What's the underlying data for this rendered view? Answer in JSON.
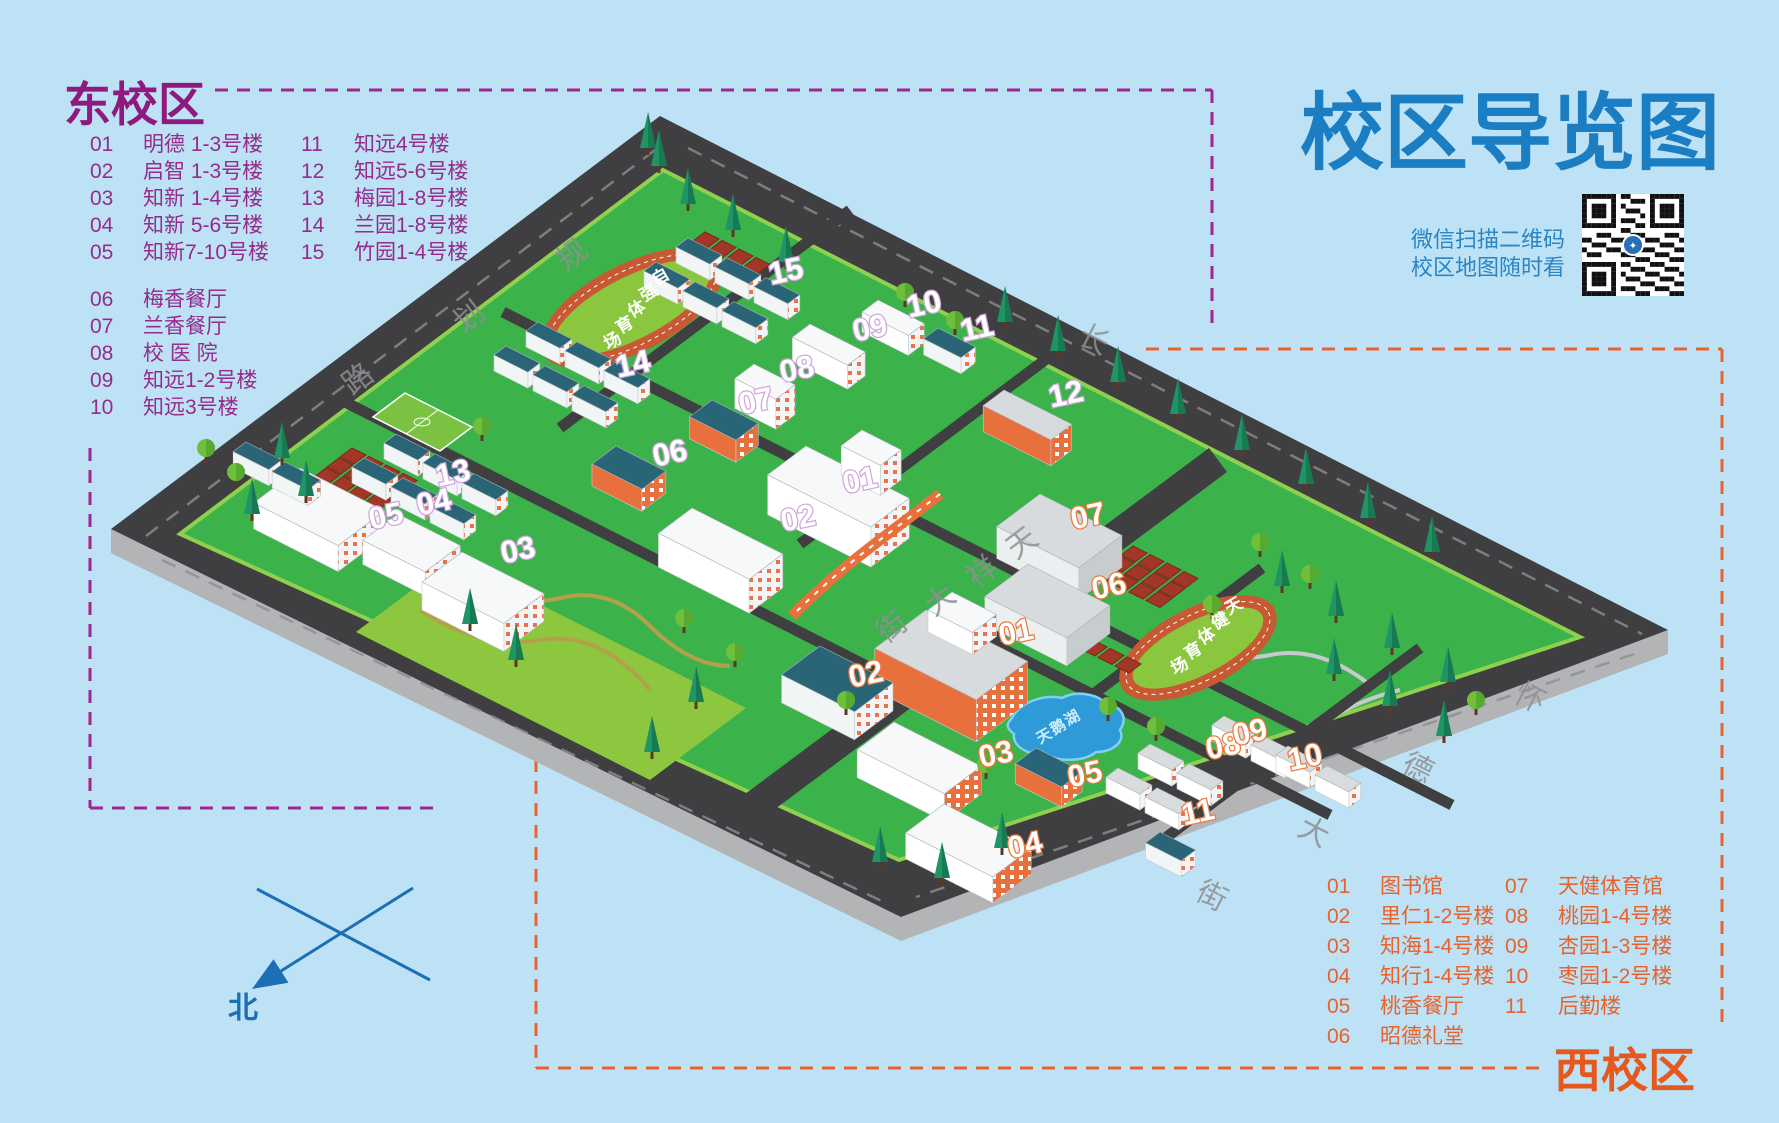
{
  "title": "校区导览图",
  "qr_note": {
    "line1": "微信扫描二维码",
    "line2": "校区地图随时看"
  },
  "compass": {
    "north": "北"
  },
  "legend_east": {
    "title": "东校区",
    "items_col1": [
      {
        "num": "01",
        "label": "明德 1-3号楼"
      },
      {
        "num": "02",
        "label": "启智 1-3号楼"
      },
      {
        "num": "03",
        "label": "知新 1-4号楼"
      },
      {
        "num": "04",
        "label": "知新 5-6号楼"
      },
      {
        "num": "05",
        "label": "知新7-10号楼"
      },
      {
        "num": "06",
        "label": "梅香餐厅"
      },
      {
        "num": "07",
        "label": "兰香餐厅"
      },
      {
        "num": "08",
        "label": "校 医 院"
      },
      {
        "num": "09",
        "label": "知远1-2号楼"
      },
      {
        "num": "10",
        "label": "知远3号楼"
      }
    ],
    "items_col2": [
      {
        "num": "11",
        "label": "知远4号楼"
      },
      {
        "num": "12",
        "label": "知远5-6号楼"
      },
      {
        "num": "13",
        "label": "梅园1-8号楼"
      },
      {
        "num": "14",
        "label": "兰园1-8号楼"
      },
      {
        "num": "15",
        "label": "竹园1-4号楼"
      }
    ]
  },
  "legend_west": {
    "title": "西校区",
    "items_col1": [
      {
        "num": "01",
        "label": "图书馆"
      },
      {
        "num": "02",
        "label": "里仁1-2号楼"
      },
      {
        "num": "03",
        "label": "知海1-4号楼"
      },
      {
        "num": "04",
        "label": "知行1-4号楼"
      },
      {
        "num": "05",
        "label": "桃香餐厅"
      },
      {
        "num": "06",
        "label": "昭德礼堂"
      }
    ],
    "items_col2": [
      {
        "num": "07",
        "label": "天健体育馆"
      },
      {
        "num": "08",
        "label": "桃园1-4号楼"
      },
      {
        "num": "09",
        "label": "杏园1-3号楼"
      },
      {
        "num": "10",
        "label": "枣园1-2号楼"
      },
      {
        "num": "11",
        "label": "后勤楼"
      }
    ]
  },
  "map": {
    "roads": [
      {
        "name": "规划路",
        "chars": [
          {
            "ch": "规",
            "x": 566,
            "y": 272,
            "r": -37
          },
          {
            "ch": "划",
            "x": 463,
            "y": 334,
            "r": -37
          },
          {
            "ch": "路",
            "x": 352,
            "y": 396,
            "r": -37
          }
        ]
      },
      {
        "name": "长",
        "chars": [
          {
            "ch": "长",
            "x": 1076,
            "y": 342,
            "r": 27
          }
        ]
      },
      {
        "name": "怀德大街",
        "chars": [
          {
            "ch": "怀",
            "x": 1512,
            "y": 700,
            "r": 27
          },
          {
            "ch": "德",
            "x": 1400,
            "y": 770,
            "r": 27
          },
          {
            "ch": "大",
            "x": 1296,
            "y": 834,
            "r": 27
          },
          {
            "ch": "街",
            "x": 1194,
            "y": 898,
            "r": 27
          }
        ]
      },
      {
        "name": "天祥大街",
        "chars": [
          {
            "ch": "天",
            "x": 1016,
            "y": 560,
            "r": -37
          },
          {
            "ch": "祥",
            "x": 976,
            "y": 589,
            "r": -37
          },
          {
            "ch": "大",
            "x": 934,
            "y": 617,
            "r": -37
          },
          {
            "ch": "街",
            "x": 886,
            "y": 644,
            "r": -37
          }
        ]
      }
    ],
    "stadiums": [
      {
        "name": "自强体育场",
        "x": 656,
        "y": 286,
        "dx": -12,
        "dy": 16,
        "r": -30
      },
      {
        "name": "天健体育场",
        "x": 1229,
        "y": 615,
        "dx": -13.5,
        "dy": 15,
        "r": -30
      }
    ],
    "lake": {
      "name": "天鹅湖",
      "x": 1040,
      "y": 744,
      "dx": 14,
      "dy": -9,
      "r": -30
    },
    "markers_east": [
      {
        "num": "01",
        "x": 862,
        "y": 490
      },
      {
        "num": "02",
        "x": 800,
        "y": 528
      },
      {
        "num": "03",
        "x": 520,
        "y": 560
      },
      {
        "num": "04",
        "x": 436,
        "y": 512
      },
      {
        "num": "05",
        "x": 388,
        "y": 526
      },
      {
        "num": "06",
        "x": 672,
        "y": 463
      },
      {
        "num": "07",
        "x": 758,
        "y": 411
      },
      {
        "num": "08",
        "x": 799,
        "y": 379
      },
      {
        "num": "09",
        "x": 872,
        "y": 338
      },
      {
        "num": "10",
        "x": 926,
        "y": 314
      },
      {
        "num": "11",
        "x": 979,
        "y": 338
      },
      {
        "num": "12",
        "x": 1068,
        "y": 404
      },
      {
        "num": "13",
        "x": 455,
        "y": 483
      },
      {
        "num": "14",
        "x": 635,
        "y": 374
      },
      {
        "num": "15",
        "x": 788,
        "y": 281
      }
    ],
    "markers_west": [
      {
        "num": "01",
        "x": 1018,
        "y": 642
      },
      {
        "num": "02",
        "x": 868,
        "y": 684
      },
      {
        "num": "03",
        "x": 998,
        "y": 764
      },
      {
        "num": "04",
        "x": 1027,
        "y": 855
      },
      {
        "num": "05",
        "x": 1087,
        "y": 784
      },
      {
        "num": "06",
        "x": 1111,
        "y": 596
      },
      {
        "num": "07",
        "x": 1090,
        "y": 526
      },
      {
        "num": "08",
        "x": 1225,
        "y": 756
      },
      {
        "num": "09",
        "x": 1252,
        "y": 742
      },
      {
        "num": "10",
        "x": 1307,
        "y": 767
      },
      {
        "num": "11",
        "x": 1200,
        "y": 822
      }
    ]
  },
  "colors": {
    "background": "#bee2f5",
    "title_blue": "#1b7ec2",
    "east_purple": "#952c8b",
    "west_orange": "#e8622c",
    "road_dark": "#3f3f41",
    "campus_green": "#3cb24b",
    "park_green": "#8dc63f",
    "track_ring_orange": "#c75a33",
    "track_infield_green": "#8bc63f",
    "lake_blue": "#2f9ad8",
    "compass_blue": "#1a6fb5"
  }
}
